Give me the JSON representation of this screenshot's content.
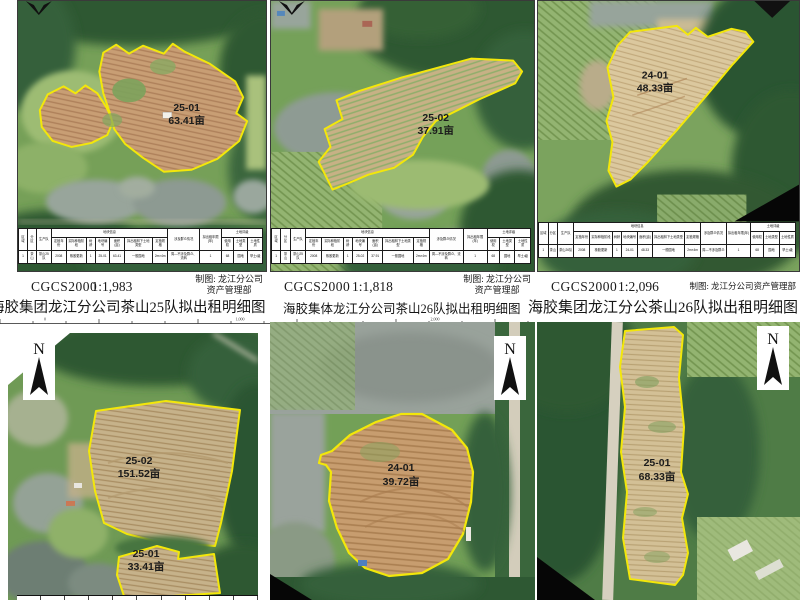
{
  "sheet": {
    "titles": [
      "海胶集团龙江分公司茶山25队拟出租明细图",
      "海胶集体龙江分公司茶山26队拟出租明细图",
      "海胶集团龙江分公茶山26队拟出租明细图"
    ]
  },
  "colors": {
    "parcel_outline": "#f3e70a",
    "north_arrow": "#111111"
  },
  "north_label": "N",
  "ruler_labels": [
    "0",
    "1,000",
    "2,000"
  ],
  "table": {
    "fixed": [
      "区域",
      "分区",
      "生产队"
    ],
    "group_plot": "地块信息",
    "plot_cols": [
      "定植年份",
      "实际种植阶段",
      "树龄",
      "地块编号",
      "面积(亩)",
      "拟出租林下土地类型",
      "定植规格"
    ],
    "mid_cols": [
      "涉及群众情况",
      "拟出租年限(年)"
    ],
    "group_grade": "土地评级",
    "grade_cols": [
      "使用权",
      "土地类型",
      "土地性质"
    ]
  },
  "top_panels": [
    {
      "crs": "CGCS2000",
      "scale": "1:1,983",
      "maker1": "制图: 龙江分公司",
      "maker2": "资产管理部",
      "parcels": [
        {
          "code": "25-01",
          "area": "63.41亩"
        }
      ],
      "table_row": [
        "1",
        "茶山",
        "茶山25队",
        "2008",
        "橡胶更新",
        "1",
        "25-01",
        "63.41",
        "一般园地",
        "2m×4m",
        "周—不涉及群众、流转",
        "1",
        "68",
        "园地",
        "旱土Ⅰ级"
      ]
    },
    {
      "crs": "CGCS2000",
      "scale": "1:1,818",
      "maker1": "制图: 龙江分公司",
      "maker2": "资产管理部",
      "parcels": [
        {
          "code": "25-02",
          "area": "37.91亩"
        }
      ],
      "table_row": [
        "1",
        "茶山",
        "茶山25队",
        "2008",
        "橡胶更新",
        "1",
        "25-02",
        "37.91",
        "一般园地",
        "2m×4m",
        "周—不涉及群众、流转",
        "1",
        "68",
        "园地",
        "旱土Ⅰ级"
      ]
    },
    {
      "crs": "CGCS2000",
      "scale": "1:2,096",
      "maker1": "制图: 龙江分公司资产管理部",
      "maker2": "",
      "parcels": [
        {
          "code": "24-01",
          "area": "48.33亩"
        }
      ],
      "table_row": [
        "1",
        "茶山",
        "茶山26队",
        "2008",
        "橡胶更新",
        "1",
        "24-01",
        "48.33",
        "一般园地",
        "2m×4m",
        "周—不涉及群众",
        "1",
        "68",
        "园地",
        "旱土Ⅰ级"
      ]
    }
  ],
  "bottom_panels": [
    {
      "parcels": [
        {
          "code": "25-02",
          "area": "151.52亩"
        },
        {
          "code": "25-01",
          "area": "33.41亩"
        }
      ]
    },
    {
      "parcels": [
        {
          "code": "24-01",
          "area": "39.72亩"
        }
      ]
    },
    {
      "parcels": [
        {
          "code": "25-01",
          "area": "68.33亩"
        }
      ]
    }
  ]
}
